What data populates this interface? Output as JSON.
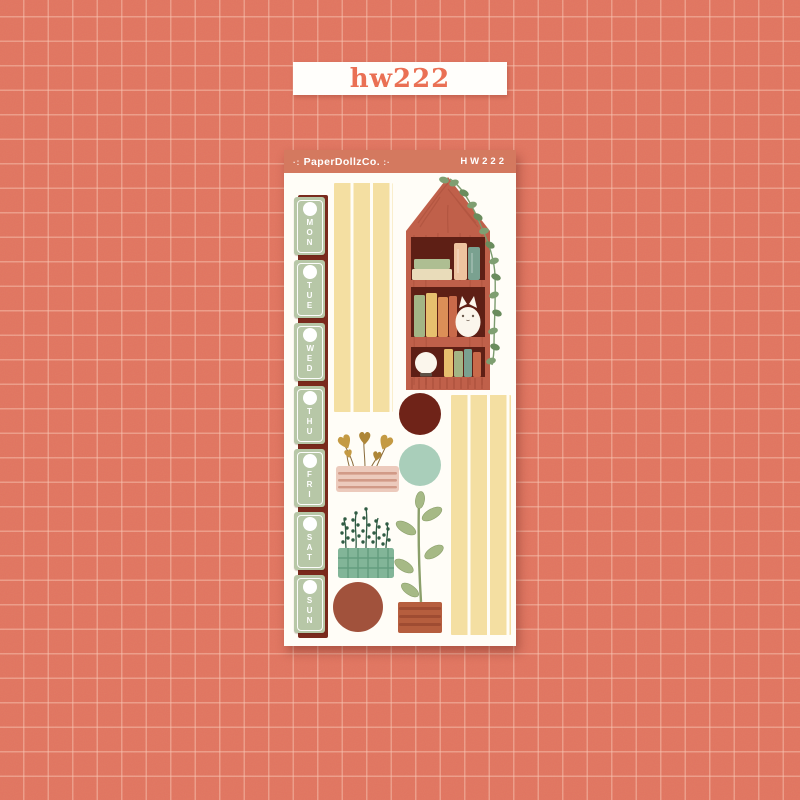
{
  "page": {
    "watermark_label": "hw222"
  },
  "sheet": {
    "brand": "PaperDollzCo.",
    "brand_deco_left": "·:",
    "brand_deco_right": ":·",
    "sku": "HW222",
    "days": [
      "MON",
      "TUE",
      "WED",
      "THU",
      "FRI",
      "SAT",
      "SUN"
    ]
  },
  "illustrations": {
    "bookshelf": "house-shaped red bookshelf with books, white cat, globe lamp and trailing vine",
    "washi_strips": "cream striped washi strips",
    "hanging_plant": "gold heart-leaf hanging plant in pink striped planter",
    "sprig_plant": "dark green sprigs in teal checked planter",
    "tall_plant": "leafy stem plant in terracotta pot",
    "dot_stickers": "maroon, mint and brown circle stickers"
  },
  "colors": {
    "bg": "#e07560",
    "label_bg": "#fffefb",
    "label_text": "#ea7054",
    "header": "#d4795f",
    "sheet": "#fffdf7",
    "maroon": "#7a2a1d",
    "day_green": "#b7c7a7",
    "washi": "#f4dfa2",
    "house": "#c0604a",
    "house_interior": "#5e1f15",
    "circle_maroon": "#6f2318",
    "circle_mint": "#a9ceba",
    "circle_brown": "#a1523c"
  }
}
